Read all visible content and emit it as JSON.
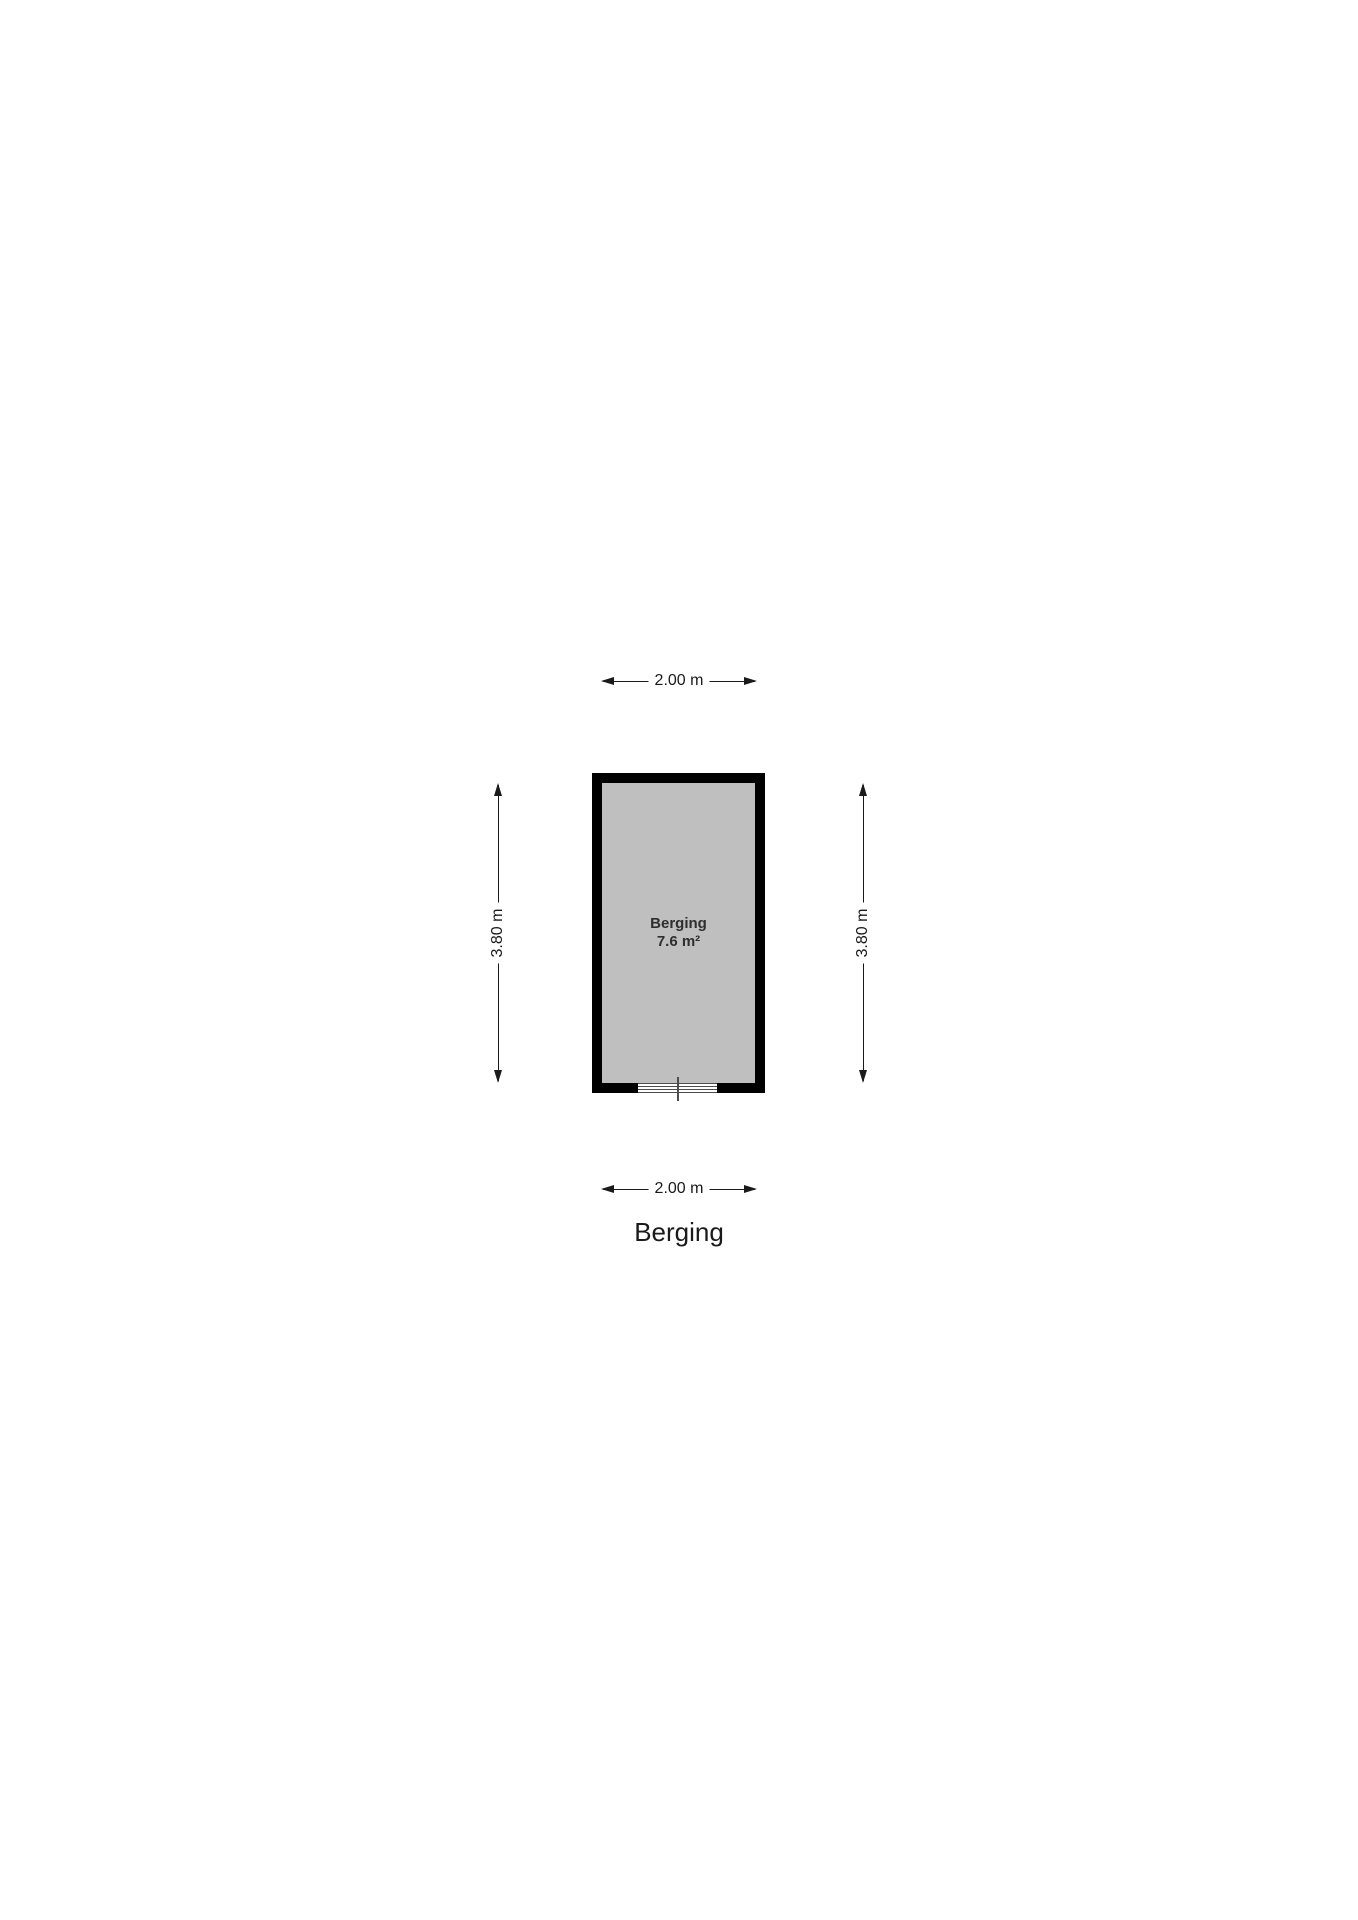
{
  "floorplan": {
    "title": "Berging",
    "room": {
      "name": "Berging",
      "area": "7.6 m²"
    },
    "dimensions": {
      "width_top": "2.00 m",
      "width_bottom": "2.00 m",
      "height_left": "3.80 m",
      "height_right": "3.80 m"
    },
    "colors": {
      "background": "#ffffff",
      "wall": "#000000",
      "floor": "#bfbfbf",
      "dimension_text": "#1a1a1a",
      "room_label_text": "#2e2e2e",
      "door_lines": "#4d4d4d"
    }
  }
}
